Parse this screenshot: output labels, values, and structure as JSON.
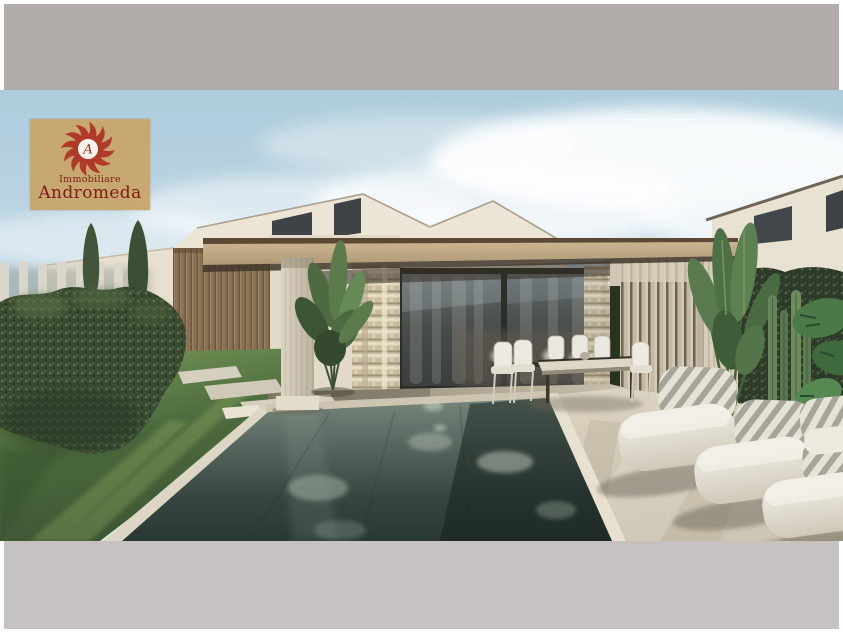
{
  "frame": {
    "page_background": "#ffffff",
    "top_band_color": "#b1acaa",
    "bottom_band_color": "#c6c2c1"
  },
  "watermark": {
    "line1": "Immobiliare",
    "line2": "Andromeda",
    "monogram": "A",
    "background_color": "#c9a76e",
    "sun_color": "#b03522",
    "text_color": "#7d150e"
  },
  "scene": {
    "type": "architectural-rendering",
    "description": "Modern single-storey villas with a flat pergola canopy, travertine column and slatted walls, full-height glass sliding doors with sheer checkered curtains, outdoor dining set, dark infinity pool, lawn with stepping stones, tall hedge with two cypress trees, tropical plants and a diagonal row of white sun loungers on a travertine deck under a pale cloudy sky",
    "palette": {
      "sky": "#b7d2e0",
      "cloud": "#ffffff",
      "wall_cream": "#ece4d4",
      "wood_slats": "#8a7154",
      "canopy_tan": "#c4ae8a",
      "travertine": "#d6cebb",
      "glass": "#474c4b",
      "hedge_green": "#3b4b33",
      "grass_green": "#5d7c47",
      "pool_water": "#3c4b44",
      "deck_stone": "#d3cab7",
      "lounger_cream": "#eceadf"
    }
  }
}
